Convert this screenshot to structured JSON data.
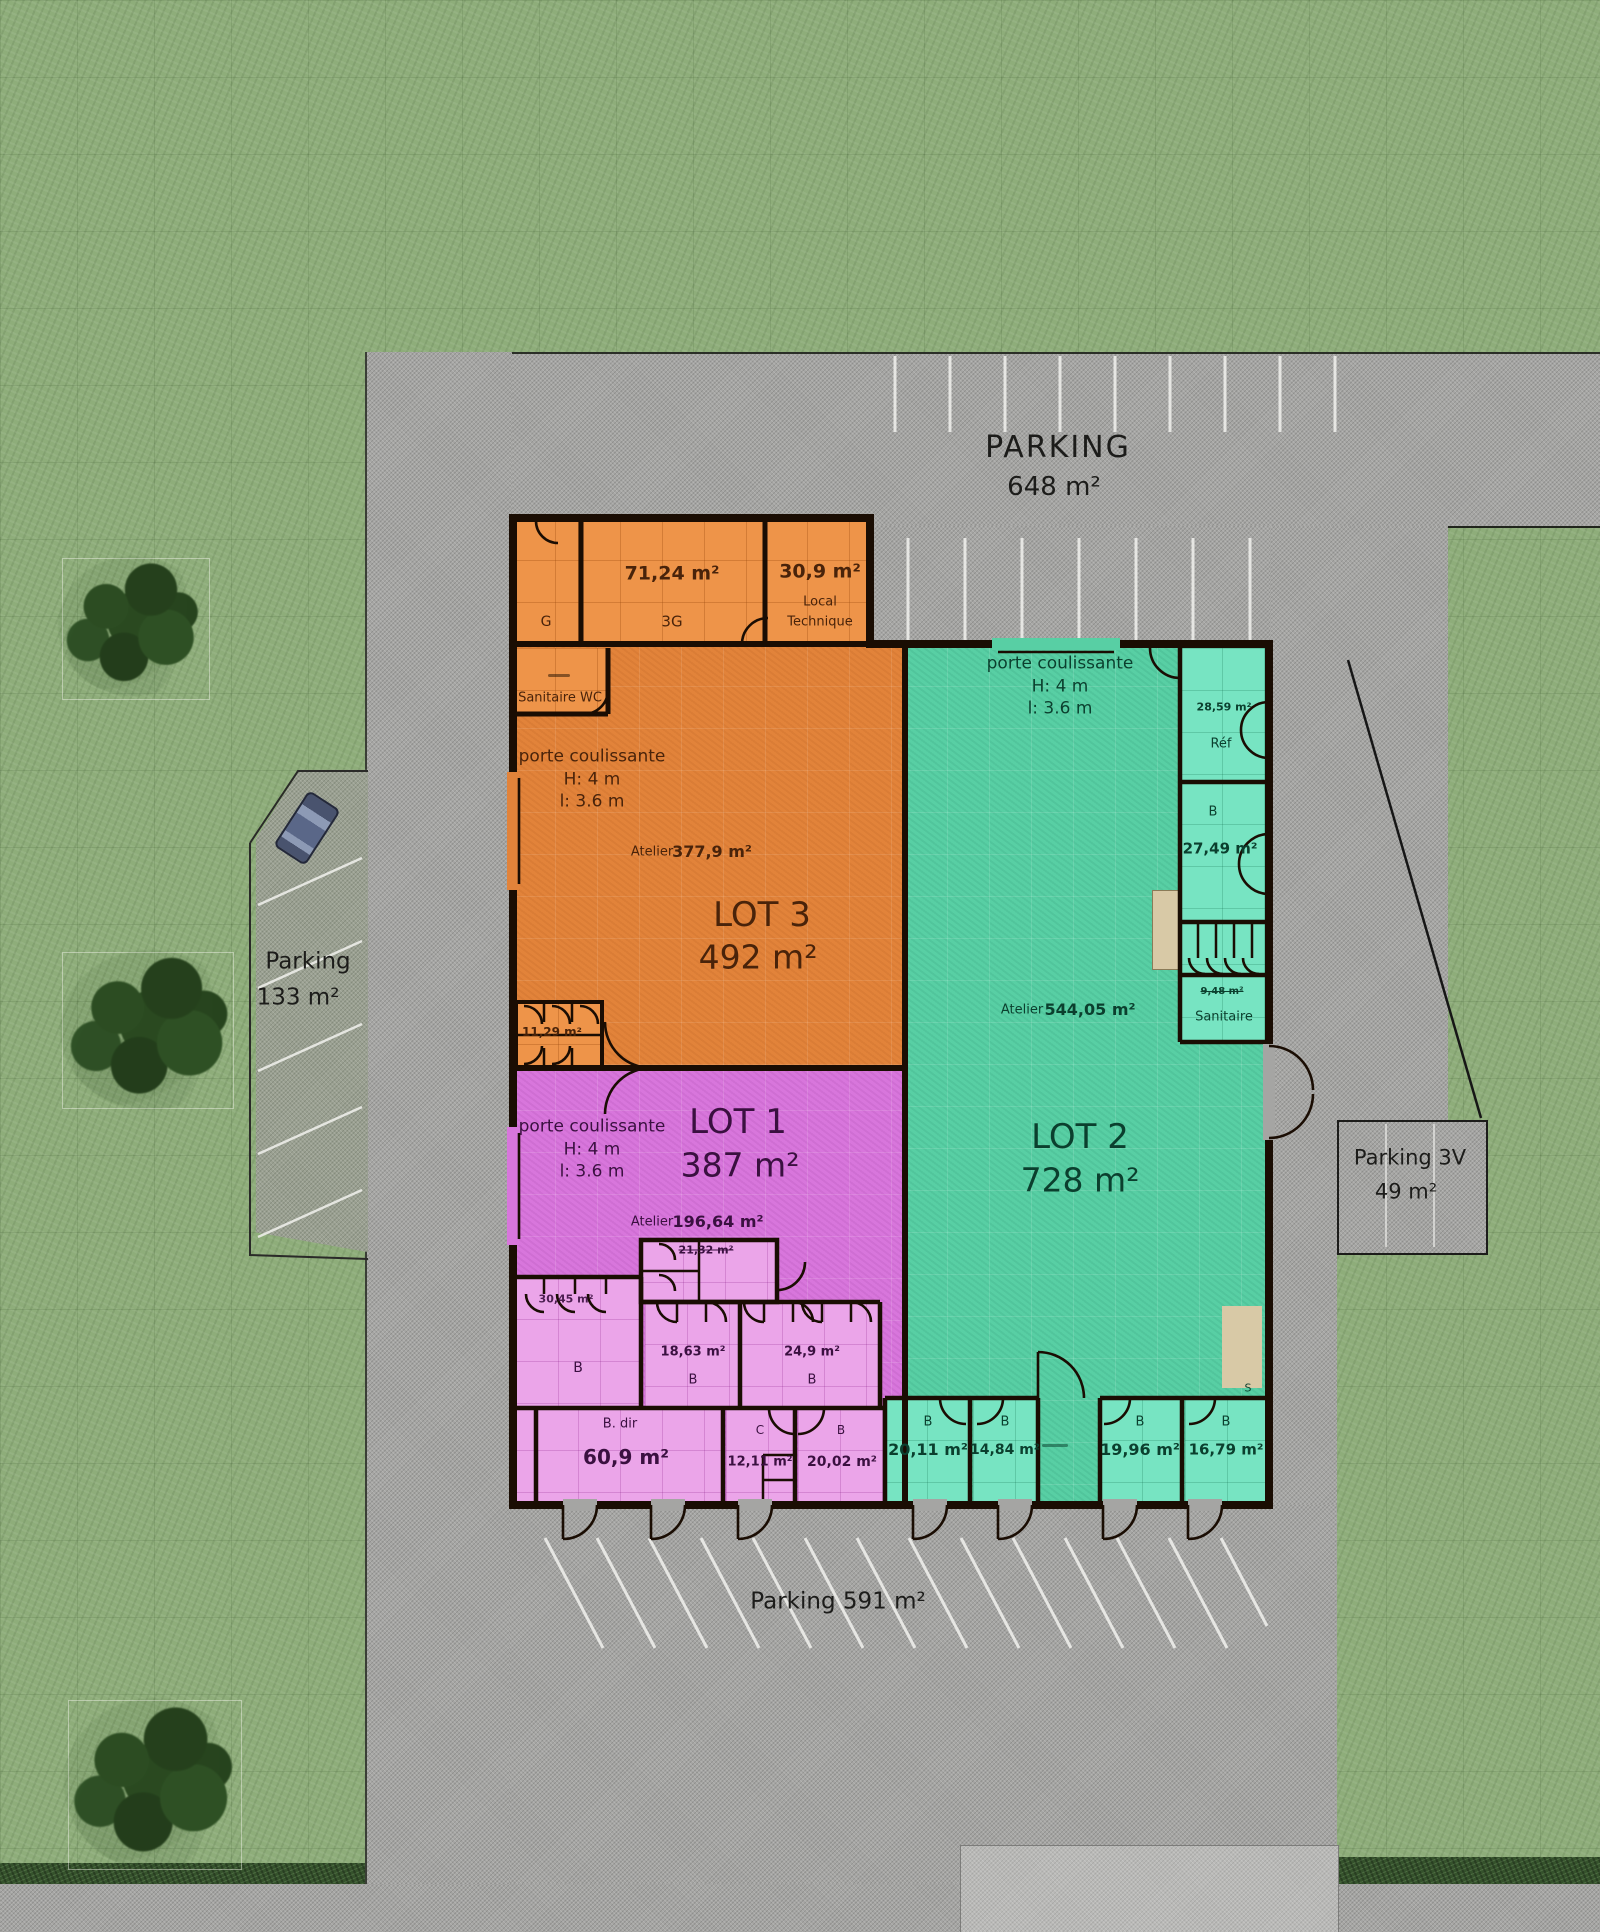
{
  "site": {
    "parking_top": {
      "name": "PARKING",
      "area": "648 m²"
    },
    "parking_left": {
      "name": "Parking",
      "area": "133 m²"
    },
    "parking_3v": {
      "name": "Parking 3V",
      "area": "49 m²"
    },
    "parking_bottom": {
      "label": "Parking 591 m²"
    }
  },
  "annex": {
    "g": {
      "name": "G"
    },
    "g3": {
      "area": "71,24 m²",
      "name": "3G"
    },
    "local_technique": {
      "area": "30,9 m²",
      "name_line1": "Local",
      "name_line2": "Technique"
    }
  },
  "lot3": {
    "name": "LOT 3",
    "area": "492 m²",
    "door": {
      "line1": "porte coulissante",
      "line2": "H: 4 m",
      "line3": "l: 3.6 m"
    },
    "atelier": {
      "label": "Atelier",
      "area": "377,9 m²"
    },
    "sanitaire_wc": {
      "name": "Sanitaire WC"
    },
    "room_1129": {
      "area": "11,29 m²"
    }
  },
  "lot1": {
    "name": "LOT 1",
    "area": "387 m²",
    "door": {
      "line1": "porte coulissante",
      "line2": "H: 4 m",
      "line3": "l: 3.6 m"
    },
    "atelier": {
      "label": "Atelier",
      "area": "196,64 m²"
    },
    "room_2132": {
      "area": "21,32 m²"
    },
    "room_3045": {
      "area": "30,45 m²"
    },
    "room_b": {
      "name": "B"
    },
    "room_1863": {
      "area": "18,63 m²",
      "name": "B"
    },
    "room_249": {
      "area": "24,9 m²",
      "name": "B"
    },
    "room_bdir": {
      "name": "B. dir",
      "area": "60,9 m²"
    },
    "room_c": {
      "name": "C",
      "area": "12,11 m²"
    },
    "room_2002": {
      "name": "B",
      "area": "20,02 m²"
    }
  },
  "lot2": {
    "name": "LOT 2",
    "area": "728 m²",
    "door": {
      "line1": "porte coulissante",
      "line2": "H: 4 m",
      "line3": "l: 3.6 m"
    },
    "atelier": {
      "label": "Atelier",
      "area": "544,05 m²"
    },
    "room_ref": {
      "area": "28,59 m²",
      "name": "Réf"
    },
    "room_2749": {
      "name": "B",
      "area": "27,49 m²"
    },
    "sanitaire": {
      "name": "Sanitaire",
      "area_struck": "9,48 m²"
    },
    "room_2011": {
      "name": "B",
      "area": "20,11 m²"
    },
    "room_1484": {
      "name": "B",
      "area": "14,84 m²"
    },
    "room_1996": {
      "name": "B",
      "area": "19,96 m²"
    },
    "room_1679": {
      "name": "B",
      "area": "16,79 m²"
    },
    "exit": {
      "label": "S"
    }
  },
  "colors": {
    "lot1": "#d876dc",
    "lot1_rooms": "#eba5e9",
    "lot2": "#58cfa4",
    "lot2_rooms": "#77e4c2",
    "lot3": "#e2833a",
    "annex_rooms": "#ee9449",
    "wall": "#1a0d03",
    "road": "#a5a5a3",
    "grass": "#8ead7a",
    "dock": "#d8c9a6"
  }
}
